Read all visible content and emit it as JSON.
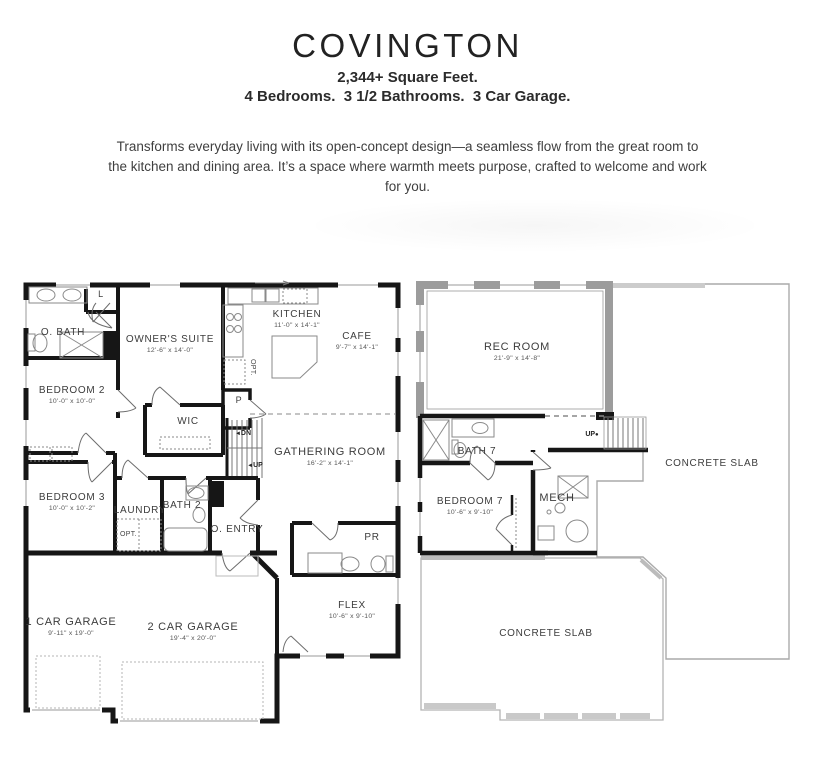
{
  "header": {
    "title": "COVINGTON",
    "subtitle_line1": "2,344+ Square Feet.",
    "subtitle_line2": "4 Bedrooms.  3 1/2 Bathrooms.  3 Car Garage.",
    "description": "Transforms everyday living with its open-concept design—a seamless flow from the great room to the kitchen and dining area. It’s a space where warmth meets purpose, crafted to welcome and work for you."
  },
  "first_floor": {
    "rooms": {
      "o_bath": {
        "name": "O. BATH",
        "dims": ""
      },
      "linen": {
        "name": "L",
        "dims": ""
      },
      "owners_suite": {
        "name": "OWNER'S SUITE",
        "dims": "12'-6\" x 14'-0\""
      },
      "kitchen": {
        "name": "KITCHEN",
        "dims": "11'-0\" x 14'-1\""
      },
      "cafe": {
        "name": "CAFE",
        "dims": "9'-7\" x 14'-1\""
      },
      "bedroom2": {
        "name": "BEDROOM 2",
        "dims": "10'-0\" x 10'-0\""
      },
      "wic": {
        "name": "WIC",
        "dims": ""
      },
      "pantry": {
        "name": "P",
        "dims": ""
      },
      "gathering": {
        "name": "GATHERING ROOM",
        "dims": "16'-2\" x 14'-1\""
      },
      "bedroom3": {
        "name": "BEDROOM 3",
        "dims": "10'-0\" x 10'-2\""
      },
      "laundry": {
        "name": "LAUNDRY",
        "dims": ""
      },
      "bath2": {
        "name": "BATH 2",
        "dims": ""
      },
      "o_entry": {
        "name": "O. ENTRY",
        "dims": ""
      },
      "pr": {
        "name": "PR",
        "dims": ""
      },
      "flex": {
        "name": "FLEX",
        "dims": "10'-6\" x 9'-10\""
      },
      "garage1": {
        "name": "1 CAR GARAGE",
        "dims": "9'-11\" x 19'-0\""
      },
      "garage2": {
        "name": "2 CAR GARAGE",
        "dims": "19'-4\" x 20'-0\""
      }
    },
    "annotations": {
      "dn": "DN",
      "up": "UP",
      "arrow": "◄",
      "opt_kitchen": "OPT.",
      "opt_laundry": "OPT."
    }
  },
  "second_floor": {
    "rooms": {
      "rec_room": {
        "name": "REC ROOM",
        "dims": "21'-9\" x 14'-8\""
      },
      "bath7": {
        "name": "BATH 7",
        "dims": ""
      },
      "bedroom7": {
        "name": "BEDROOM 7",
        "dims": "10'-6\" x 9'-10\""
      },
      "mech": {
        "name": "MECH",
        "dims": ""
      },
      "slab_right": {
        "name": "CONCRETE SLAB",
        "dims": ""
      },
      "slab_bottom": {
        "name": "CONCRETE SLAB",
        "dims": ""
      }
    },
    "annotations": {
      "up": "UP",
      "dot": "●"
    }
  },
  "colors": {
    "wall": "#161616",
    "grey_wall": "#9c9c9c",
    "slab_line": "#aaaaaa",
    "thin_line": "#666666"
  }
}
